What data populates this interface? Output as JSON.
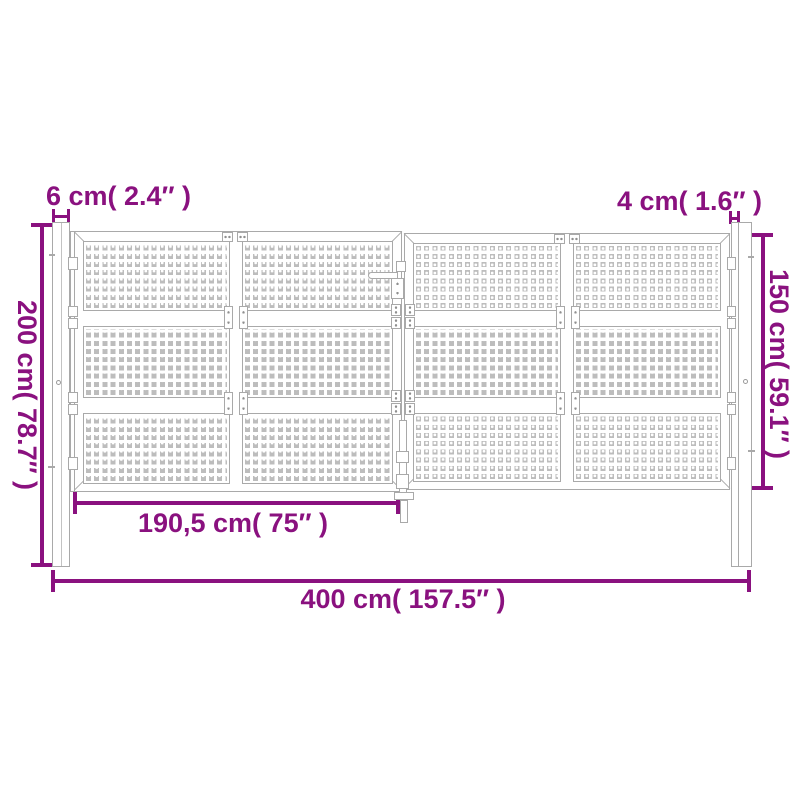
{
  "figure": {
    "type": "product-dimension-diagram",
    "subject": "double garden gate with square-perforated mesh panels and two posts"
  },
  "colors": {
    "dimension": "#8A117F",
    "outline": "#A9A9A9",
    "mesh": "#BDBDBD",
    "background": "#FFFFFF"
  },
  "labels": {
    "post_width": "6 cm( 2.4″ )",
    "frame_depth": "4 cm( 1.6″ )",
    "total_height": "200 cm( 78.7″ )",
    "infill_height": "150 cm( 59.1″ )",
    "leaf_width": "190,5 cm( 75″ )",
    "total_width": "400 cm( 157.5″ )"
  }
}
